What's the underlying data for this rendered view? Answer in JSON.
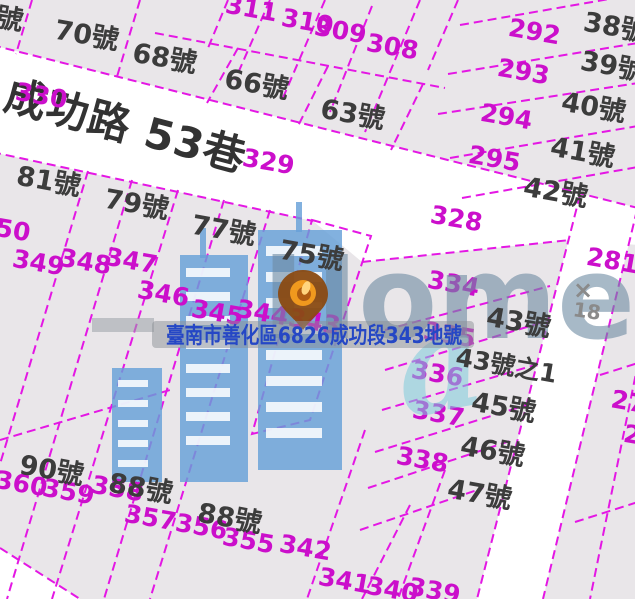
{
  "road": {
    "name": "成功路 53巷"
  },
  "annotation": {
    "text": "臺南市善化區6826成功段343地號"
  },
  "watermark": {
    "brand": "Home",
    "swirl": "a"
  },
  "survey_mark": {
    "symbol": "×",
    "value": "18"
  },
  "highlighted_parcel": {
    "number": "343",
    "house_number": "75號"
  },
  "house_numbers": {
    "edge": "號",
    "n70": "70號",
    "n68": "68號",
    "n66": "66號",
    "n63": "63號",
    "n38": "38號",
    "n39": "39號",
    "n40": "40號",
    "n41": "41號",
    "n42": "42號",
    "n81": "81號",
    "n79": "79號",
    "n77": "77號",
    "n75": "75號",
    "n43": "43號",
    "n43_1": "43號之1",
    "n45": "45號",
    "n46": "46號",
    "n47": "47號",
    "n90": "90號",
    "n88a": "88號",
    "n88b": "88號"
  },
  "parcels": {
    "p311": "311",
    "p310": "310",
    "p309": "309",
    "p308": "308",
    "p292": "292",
    "p293": "293",
    "p294": "294",
    "p295": "295",
    "p328": "328",
    "p329": "329",
    "p330": "330",
    "p334": "334",
    "p335": "335",
    "p336": "336",
    "p337": "337",
    "p338": "338",
    "p339": "339",
    "p340": "340",
    "p341": "341",
    "p342": "342",
    "p343": "343",
    "p344": "344",
    "p345": "345",
    "p346": "346",
    "p347": "347",
    "p348": "348",
    "p349": "349",
    "p350": "350",
    "p355": "355",
    "p356": "356",
    "p357": "357",
    "p358": "358",
    "p359": "359",
    "p360": "360",
    "p281": "281",
    "p27": "27",
    "p2": "2"
  },
  "colors": {
    "boundary_line": "#e417e4",
    "highlight_fill": "#f2a8a8",
    "parcel_fill": "#e9e6e9",
    "road_fill": "#ffffff",
    "house_label": "#3c3c3c",
    "parcel_label": "#cb0fcb",
    "annotation_text": "#2547c5",
    "watermark_text": "#6e8ba3",
    "watermark_accent": "#7ecbdc",
    "building": "#66a0d8",
    "pin": "#e8930c",
    "survey_mark": "#8a8a8a"
  }
}
